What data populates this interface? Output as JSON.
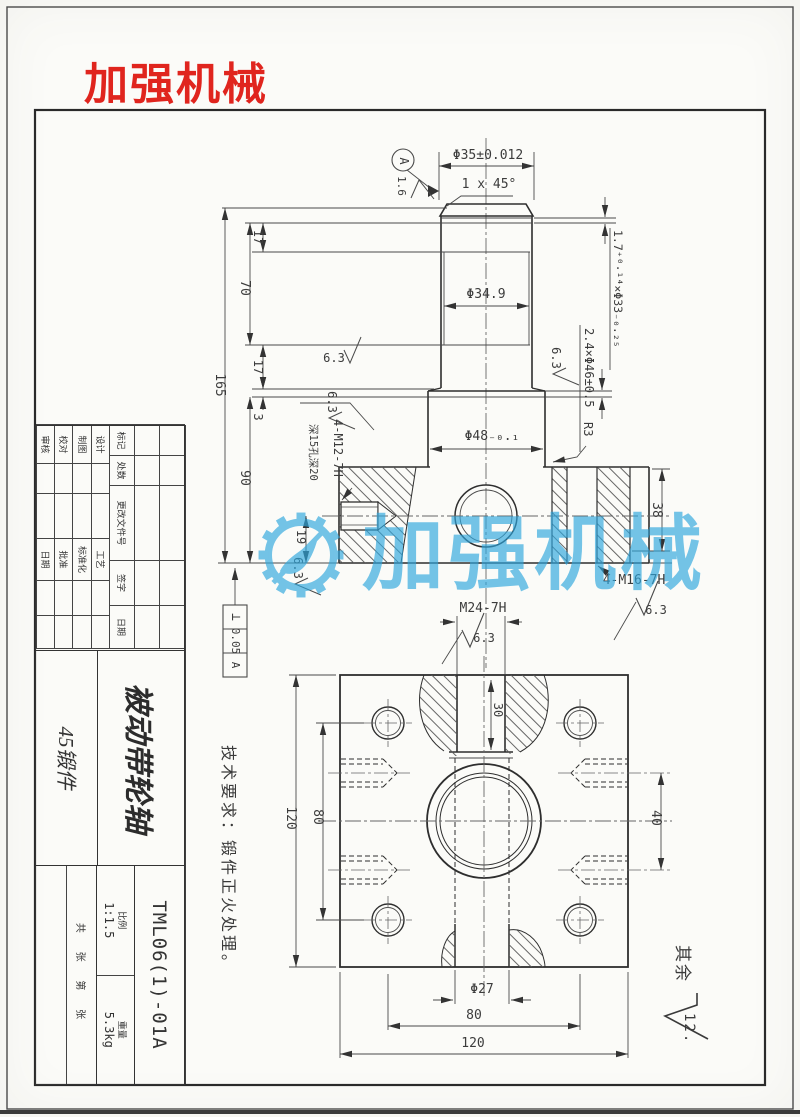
{
  "page": {
    "bg": "#fbfbf8",
    "line_color": "#333333",
    "accent_red": "#e0251e",
    "watermark_color": "#2ea7de"
  },
  "brand": {
    "logo_text": "加强机械",
    "watermark_text": "加强机械"
  },
  "labels": {
    "dia35": "Φ35±0.012",
    "chamfer": "1 x 45°",
    "datum_a": "A",
    "r16": "1.6",
    "groove1": "1.7⁺⁰·¹⁴×Φ33₋₀.₂₅",
    "dia349": "Φ34.9",
    "groove2": "2.4×Φ46±0.5",
    "dia48": "Φ48₋₀.₁",
    "m12": "4-M12-7H",
    "m12_depth": "深15孔深20",
    "r3": "R3",
    "d17": "17",
    "d3": "3",
    "d70": "70",
    "d165": "165",
    "d90": "90",
    "d19": "19",
    "d38": "38",
    "m16": "4-M16-7H",
    "m24": "M24-7H",
    "d30": "30",
    "d40": "40",
    "d80": "80",
    "d120": "120",
    "dia27": "Φ27",
    "r63": "6.3",
    "r125": "12.5",
    "rest": "其余",
    "fcf_sym": "⊥",
    "fcf_val": "0.05",
    "tech": "技术要求：锻件正火处理。"
  },
  "title_block": {
    "revision_headers": [
      "标记",
      "处数",
      "更改文件号",
      "签字",
      "日期"
    ],
    "signature_rows": [
      {
        "left": "设计",
        "right": "工艺"
      },
      {
        "left": "制图",
        "right": "标准化"
      },
      {
        "left": "校对",
        "right": "批准"
      },
      {
        "left": "审核",
        "right": "日期"
      }
    ],
    "part_name": "被动带轮轴",
    "material": "45锻件",
    "drawing_no": "TML06(1)-01A",
    "scale_label": "比例",
    "scale_value": "1:1.5",
    "weight_label": "重量",
    "weight_value": "5.3kg",
    "sheets_label": "共 张 第 张"
  }
}
